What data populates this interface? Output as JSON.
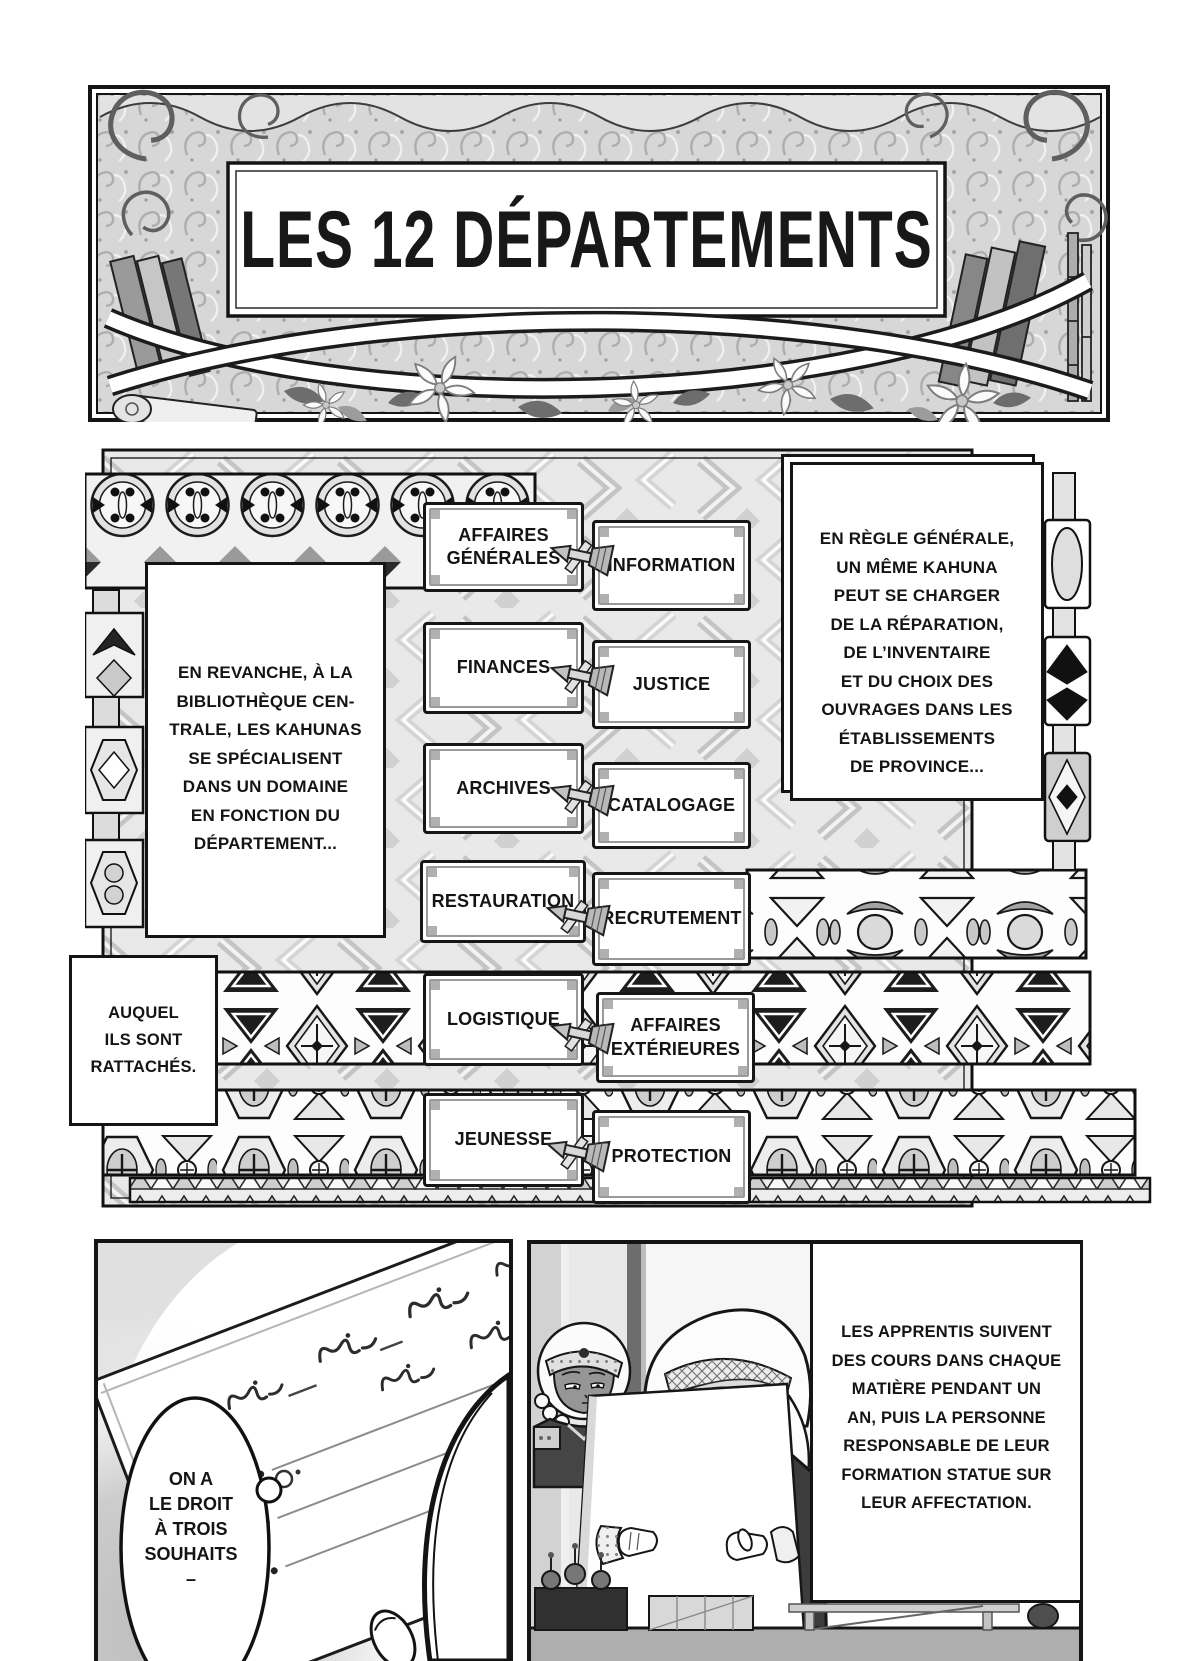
{
  "title_panel": {
    "title": "LES 12 DÉPARTEMENTS"
  },
  "departments": {
    "left": [
      "AFFAIRES GÉNÉRALES",
      "FINANCES",
      "ARCHIVES",
      "RESTAURATION",
      "LOGISTIQUE",
      "JEUNESSE"
    ],
    "right": [
      "INFORMATION",
      "JUSTICE",
      "CATALOGAGE",
      "RECRUTEMENT",
      "AFFAIRES EXTÉRIEURES",
      "PROTECTION"
    ]
  },
  "narration": {
    "rule_general": "EN RÈGLE GÉNÉRALE,\nUN MÊME KAHUNA\nPEUT SE CHARGER\nDE LA RÉPARATION,\nDE L’INVENTAIRE\nET DU CHOIX DES\nOUVRAGES DANS LES\nÉTABLISSEMENTS\nDE PROVINCE...",
    "en_revanche": "EN REVANCHE, À LA\nBIBLIOTHÈQUE CEN-\nTRALE, LES KAHUNAS\nSE SPÉCIALISENT\nDANS UN DOMAINE\nEN FONCTION DU\nDÉPARTEMENT...",
    "auquel": "AUQUEL\nILS SONT\nRATTACHÉS.",
    "apprentis": "LES APPRENTIS SUIVENT\nDES COURS DANS CHAQUE\nMATIÈRE PENDANT UN\nAN, PUIS LA PERSONNE\nRESPONSABLE DE LEUR\nFORMATION STATUE SUR\nLEUR AFFECTATION."
  },
  "speech": {
    "bubble": "ON A\nLE DROIT\nÀ TROIS\nSOUHAITS\n–"
  },
  "colors": {
    "ink": "#141414",
    "paper": "#ffffff",
    "pattern_gray": "#d9d9d9",
    "frame_gray": "#9a9a9a"
  }
}
